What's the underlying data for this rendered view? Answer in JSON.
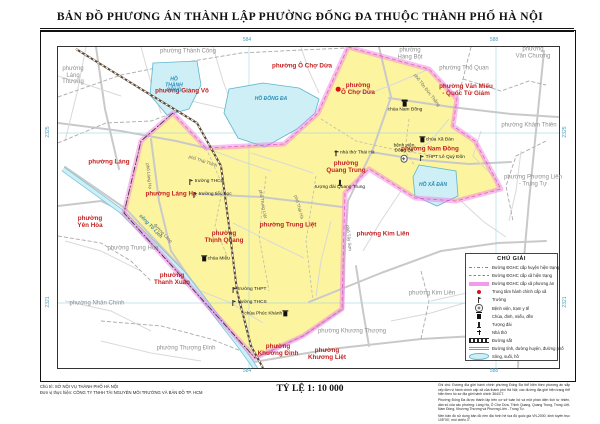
{
  "title": "BẢN ĐỒ  PHƯƠNG ÁN THÀNH LẬP PHƯỜNG ĐỐNG ĐA THUỘC THÀNH PHỐ HÀ NỘI",
  "scale_label": "TỶ LỆ 1: 10 000",
  "credits": {
    "line1": "Chủ trì: SỞ NỘI VỤ THÀNH PHỐ HÀ NỘI",
    "line2": "Đơn vị thực hiện: CÔNG TY TNHH TÀI NGUYÊN MÔI TRƯỜNG VÀ BẢN ĐỒ TP. HCM"
  },
  "note": {
    "p1": "Ghi chú: Đường địa giới hành chính phường Đống Đa thể hiện theo phương án sắp xếp đơn vị hành chính cấp xã của thành phố Hà Nội; các đường địa giới hiện trạng thể hiện theo hồ sơ địa giới hành chính 364/CT.",
    "p2": "Phường Đống Đa được thành lập trên cơ sở toàn bộ và một phần diện tích tự nhiên, dân số của các phường: Láng Hạ, Ô Chợ Dừa, Thịnh Quang, Quang Trung, Trung Liệt, Nam Đồng, Khương Thượng và Phương Liên - Trung Tự.",
    "p3": "Nền bản đồ sử dụng bản đồ nền địa hình hệ tọa độ quốc gia VN-2000, kinh tuyến trục 105°00', múi chiếu 3°."
  },
  "legend": {
    "title": "CHÚ GIẢI",
    "items": [
      {
        "sw": "dashdot",
        "label": "Đường ĐGHC cấp huyện hiện trạng"
      },
      {
        "sw": "dash",
        "label": "Đường ĐGHC cấp xã hiện trạng"
      },
      {
        "sw": "band",
        "label": "Đường ĐGHC cấp xã phương án"
      },
      {
        "sw": "dot",
        "label": "Trung tâm hành chính cấp xã"
      },
      {
        "sw": "school",
        "label": "Trường"
      },
      {
        "sw": "hospital",
        "label": "Bệnh viện, trạm y tế"
      },
      {
        "sw": "pagoda",
        "label": "Chùa, đình, miếu, đền"
      },
      {
        "sw": "monument",
        "label": "Tượng đài"
      },
      {
        "sw": "church",
        "label": "Nhà thờ"
      },
      {
        "sw": "railway",
        "label": "Đường sắt"
      },
      {
        "sw": "road",
        "label": "Đường tỉnh, đường huyện, đường phố"
      },
      {
        "sw": "water",
        "label": "Sông, suối, hồ"
      }
    ]
  },
  "colors": {
    "subject_fill": "#fcf49e",
    "boundary_pink": "#f27fe3",
    "water_fill": "#cdeff5",
    "water_edge": "#5fb4d0",
    "red_label": "#c42222",
    "gray_label": "#8f8f8f",
    "blue_label": "#2b8cb8"
  },
  "map": {
    "wards_red": [
      {
        "label": "phường Giảng Võ",
        "x": 182,
        "y": 91
      },
      {
        "label": "phường Ô Chợ Dừa",
        "x": 302,
        "y": 66
      },
      {
        "label": "phường Văn Miếu\n- Quốc Tử Giám",
        "x": 466,
        "y": 90
      },
      {
        "label": "phường Láng",
        "x": 109,
        "y": 162
      },
      {
        "label": "phường\nYên Hòa",
        "x": 90,
        "y": 222
      },
      {
        "label": "phường\nThanh Xuân",
        "x": 172,
        "y": 279
      },
      {
        "label": "phường\nKhương Đình",
        "x": 278,
        "y": 350
      },
      {
        "label": "phường\nKhương Liệt",
        "x": 327,
        "y": 354
      },
      {
        "label": "phường Kim Liên",
        "x": 383,
        "y": 234
      },
      {
        "label": "phường\nÔ Chợ Dừa",
        "x": 358,
        "y": 89
      },
      {
        "label": "phường Láng Hạ",
        "x": 171,
        "y": 194
      },
      {
        "label": "phường\nThịnh Quang",
        "x": 224,
        "y": 237
      },
      {
        "label": "phường\nQuang Trung",
        "x": 346,
        "y": 167
      },
      {
        "label": "phường Trung Liệt",
        "x": 288,
        "y": 225
      },
      {
        "label": "phường Nam Đồng",
        "x": 430,
        "y": 149
      }
    ],
    "wards_gray": [
      {
        "label": "phường Thành Công",
        "x": 188,
        "y": 52
      },
      {
        "label": "phường\nLáng\nThượng",
        "x": 73,
        "y": 76
      },
      {
        "label": "phường\nHàng Bột",
        "x": 410,
        "y": 54
      },
      {
        "label": "phường Thổ Quan",
        "x": 464,
        "y": 69
      },
      {
        "label": "phường\nVăn Chương",
        "x": 533,
        "y": 53
      },
      {
        "label": "phường Khâm Thiên",
        "x": 529,
        "y": 126
      },
      {
        "label": "phường Phương Liên\n- Trung Tự",
        "x": 533,
        "y": 181
      },
      {
        "label": "phường Trung Hòa",
        "x": 133,
        "y": 249
      },
      {
        "label": "phường Nhân Chính",
        "x": 97,
        "y": 304
      },
      {
        "label": "phường Thượng Đình",
        "x": 186,
        "y": 349
      },
      {
        "label": "phường Khương Thượng",
        "x": 352,
        "y": 332
      },
      {
        "label": "phường Kim Liên",
        "x": 432,
        "y": 294
      }
    ],
    "lakes": [
      {
        "label": "HỒ\nTHÀNH\nCÔNG",
        "x": 174,
        "y": 86
      },
      {
        "label": "HỒ ĐỐNG ĐA",
        "x": 271,
        "y": 100
      },
      {
        "label": "HỒ XÃ ĐÀN",
        "x": 433,
        "y": 186
      },
      {
        "label": "sông Tô Lịch",
        "x": 150,
        "y": 227,
        "rot": 46
      }
    ],
    "streets": [
      {
        "label": "phố Thái Thịnh",
        "x": 203,
        "y": 161,
        "rot": 18
      },
      {
        "label": "đường Láng",
        "x": 163,
        "y": 233,
        "rot": 46
      },
      {
        "label": "phố Tây Sơn",
        "x": 349,
        "y": 238,
        "rot": 84
      },
      {
        "label": "phố Thái Hà",
        "x": 299,
        "y": 207,
        "rot": 74
      },
      {
        "label": "phố Trung Liệt",
        "x": 263,
        "y": 204,
        "rot": 80
      },
      {
        "label": "phố Tôn Đức Thắng",
        "x": 427,
        "y": 90,
        "rot": 52
      },
      {
        "label": "phố Láng Hạ",
        "x": 149,
        "y": 176,
        "rot": 84
      }
    ],
    "pois": [
      {
        "icon": "dot",
        "label": "",
        "x": 338,
        "y": 89,
        "iconpos": "left"
      },
      {
        "icon": "pagoda",
        "label": "chùa Nam Đồng",
        "x": 405,
        "y": 107,
        "iconpos": "top"
      },
      {
        "icon": "hospital",
        "label": "bệnh viện\nĐống Đa",
        "x": 404,
        "y": 153,
        "iconpos": "bottom"
      },
      {
        "icon": "church",
        "label": "nhà thờ Thái Hà",
        "x": 354,
        "y": 153,
        "iconpos": "left"
      },
      {
        "icon": "pagoda",
        "label": "chùa Xã Đàn",
        "x": 437,
        "y": 140,
        "iconpos": "left"
      },
      {
        "icon": "school",
        "label": "THPT Lê Quý Đôn",
        "x": 442,
        "y": 158,
        "iconpos": "left"
      },
      {
        "icon": "monument",
        "label": "tượng đài Quang Trung",
        "x": 340,
        "y": 185,
        "iconpos": "top"
      },
      {
        "icon": "pagoda",
        "label": "chùa Miễu",
        "x": 216,
        "y": 259,
        "iconpos": "left"
      },
      {
        "icon": "school",
        "label": "trường THCS",
        "x": 206,
        "y": 182,
        "iconpos": "left"
      },
      {
        "icon": "school",
        "label": "trường tiểu học",
        "x": 212,
        "y": 195,
        "iconpos": "left"
      },
      {
        "icon": "school",
        "label": "trường THPT",
        "x": 249,
        "y": 290,
        "iconpos": "left"
      },
      {
        "icon": "school",
        "label": "trường THCS",
        "x": 249,
        "y": 303,
        "iconpos": "left"
      },
      {
        "icon": "pagoda",
        "label": "chùa Phúc Khánh",
        "x": 266,
        "y": 314,
        "iconpos": "right"
      }
    ],
    "grid_labels": [
      {
        "label": "584",
        "x": 247,
        "y": 41
      },
      {
        "label": "588",
        "x": 494,
        "y": 41
      },
      {
        "label": "584",
        "x": 247,
        "y": 372
      },
      {
        "label": "588",
        "x": 494,
        "y": 372
      },
      {
        "label": "2325",
        "x": 49,
        "y": 132,
        "rot": -90
      },
      {
        "label": "2325",
        "x": 566,
        "y": 132,
        "rot": -90
      },
      {
        "label": "2321",
        "x": 49,
        "y": 302,
        "rot": -90
      },
      {
        "label": "2321",
        "x": 566,
        "y": 302,
        "rot": -90
      }
    ]
  }
}
